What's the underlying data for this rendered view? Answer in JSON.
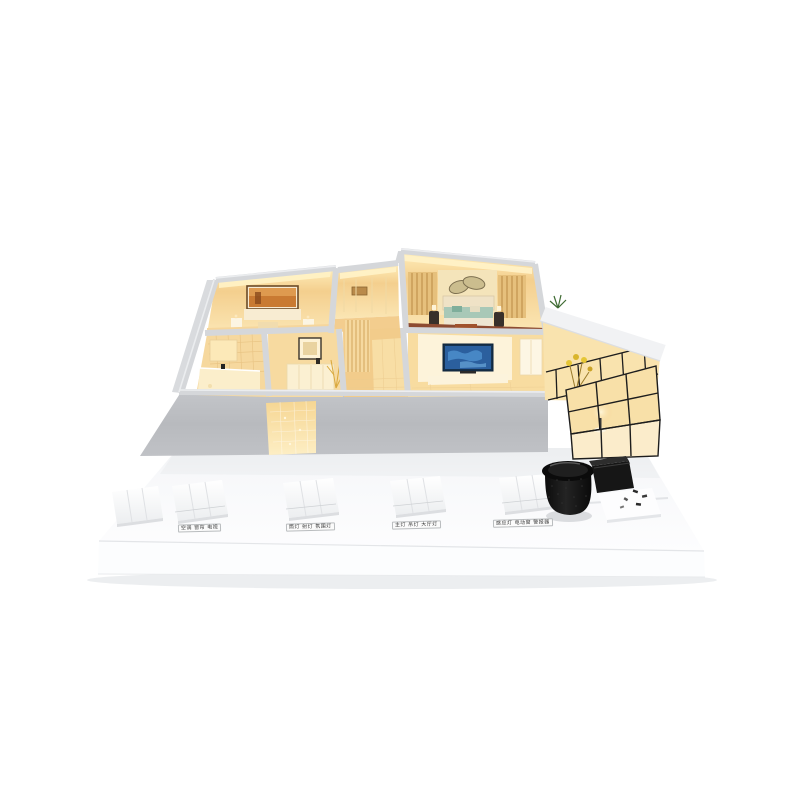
{
  "scene": {
    "description": "Product photo: miniature smart-home apartment scale model with warm-lit rooms on a white display base, five white wall-switch panels, a black fabric smart speaker, a black gateway box and a small sensor tray",
    "background_color": "#ffffff"
  },
  "model": {
    "colors": {
      "wall_cap_gray": "#d5d7da",
      "facade_gray": "#bcbec2",
      "interior_glow": "#f6d08e",
      "ceiling_light": "#fff0c2",
      "floor_warm": "#f7dfa8",
      "wood_floor_red": "#8d4b31",
      "tv_screen_blue": "#2b5f9e",
      "bedding_teal": "#a6c7b6",
      "artwork_orange": "#bf6e2a",
      "plant_green": "#4d7а3a",
      "flower_yellow": "#e5c636",
      "glass_frame_black": "#1d1d1d"
    },
    "rooms": [
      {
        "name": "second-bedroom"
      },
      {
        "name": "kitchen"
      },
      {
        "name": "master-bedroom"
      },
      {
        "name": "bathroom"
      },
      {
        "name": "dining-area"
      },
      {
        "name": "hallway"
      },
      {
        "name": "living-room"
      },
      {
        "name": "balcony"
      },
      {
        "name": "glass-sunroom"
      }
    ]
  },
  "base": {
    "color": "#fbfcfd",
    "labels": [
      "空调 窗帘 电视",
      "筒灯 射灯 氛围灯",
      "主灯 吊灯 大厅灯",
      "感应灯 电动窗 警报器"
    ],
    "switch_panels": [
      {
        "name": "switch-panel-1",
        "gangs": 3
      },
      {
        "name": "switch-panel-2",
        "gangs": 3
      },
      {
        "name": "switch-panel-3",
        "gangs": 3
      },
      {
        "name": "switch-panel-4",
        "gangs": 3
      },
      {
        "name": "switch-panel-5",
        "gangs": 3
      }
    ],
    "devices": [
      {
        "name": "smart-speaker",
        "color": "#121212"
      },
      {
        "name": "gateway-box",
        "color": "#1b1b1b"
      },
      {
        "name": "sensor-tray",
        "color": "#fdfdfe"
      }
    ]
  }
}
